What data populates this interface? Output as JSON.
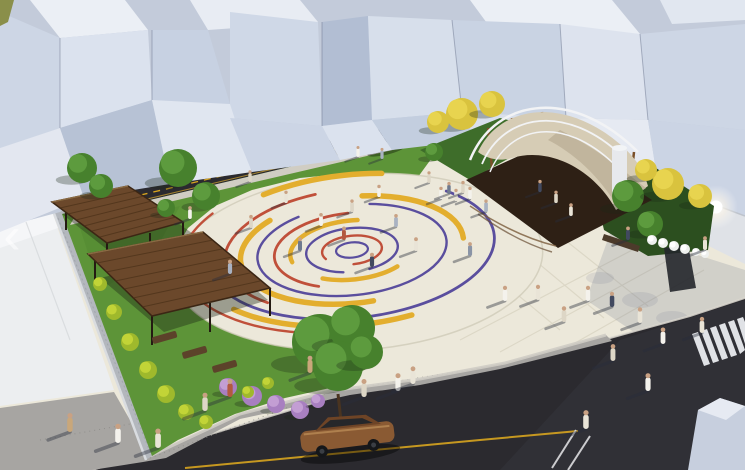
{
  "meta": {
    "title": "Aerial 3D rendering of a public plaza design",
    "description": "Urban square with concentric colored pavement circles, wooden pergolas, shade canopy stage, trees, streets and pedestrians"
  },
  "carousel": {
    "prev_glyph": "‹"
  },
  "palette": {
    "accent_red": "#c0503a",
    "accent_yellow": "#e3ae2e",
    "accent_purple": "#5a4e9e",
    "pavement_cream": "#ece8da",
    "grass_green": "#5d9438",
    "asphalt_dark": "#2b2a2f",
    "road_line_yellow": "#d7a41f",
    "wood_brown": "#6b482b",
    "canopy_tan": "#d6ccb5",
    "building_white": "#dfe5ef",
    "stone_wall_gray": "#b3b7bd",
    "car_bronze": "#8a5a33",
    "car_silver": "#c6cfdb",
    "lamp_glow": "#ffffff"
  },
  "scene": {
    "plaza": {
      "center_x": 352,
      "center_y": 250,
      "squash": 0.476,
      "rotate": -6,
      "arcs": [
        {
          "rx": 16,
          "color": "accent_purple",
          "w": 2.2,
          "dash": "100 0",
          "off": 0
        },
        {
          "rx": 30,
          "color": "accent_red",
          "w": 2.4,
          "dash": "80 20",
          "off": 55
        },
        {
          "rx": 46,
          "color": "accent_purple",
          "w": 2.4,
          "dash": "88 12",
          "off": 70
        },
        {
          "rx": 62,
          "color": "accent_yellow",
          "w": 4.5,
          "dash": "26 12 30 32",
          "off": 90
        },
        {
          "rx": 78,
          "color": "accent_red",
          "w": 2.8,
          "dash": "40 60",
          "off": 65
        },
        {
          "rx": 95,
          "color": "accent_purple",
          "w": 2.4,
          "dash": "84 16",
          "off": 20
        },
        {
          "rx": 112,
          "color": "accent_yellow",
          "w": 5.5,
          "dash": "38 18 22 22",
          "off": 78
        },
        {
          "rx": 128,
          "color": "accent_red",
          "w": 2.8,
          "dash": "30 70",
          "off": 60
        },
        {
          "rx": 143,
          "color": "accent_purple",
          "w": 2.8,
          "dash": "55 45",
          "off": 10
        },
        {
          "rx": 158,
          "color": "accent_yellow",
          "w": 5.5,
          "dash": "24 22 16 38",
          "off": 82
        },
        {
          "rx": 172,
          "color": "accent_red",
          "w": 2.4,
          "dash": "26 74",
          "off": 68
        }
      ]
    },
    "people_colors": [
      "#f4f2ec",
      "#ddd6c6",
      "#a9b2c2",
      "#6f7a8e",
      "#b3593f",
      "#41495f",
      "#e9e4d7",
      "#8a94a6",
      "#c9a77a"
    ],
    "people": [
      [
        190,
        219,
        0
      ],
      [
        230,
        274,
        2
      ],
      [
        251,
        228,
        1
      ],
      [
        286,
        203,
        6
      ],
      [
        300,
        251,
        3
      ],
      [
        321,
        226,
        0
      ],
      [
        344,
        240,
        4
      ],
      [
        352,
        212,
        1
      ],
      [
        372,
        267,
        5
      ],
      [
        379,
        197,
        0
      ],
      [
        396,
        227,
        2
      ],
      [
        416,
        251,
        6
      ],
      [
        429,
        183,
        1
      ],
      [
        441,
        199,
        0
      ],
      [
        449,
        194,
        3
      ],
      [
        456,
        201,
        6
      ],
      [
        463,
        193,
        1
      ],
      [
        470,
        199,
        0
      ],
      [
        486,
        212,
        2
      ],
      [
        470,
        256,
        7
      ],
      [
        505,
        301,
        0
      ],
      [
        538,
        300,
        6
      ],
      [
        564,
        322,
        1
      ],
      [
        588,
        301,
        0
      ],
      [
        612,
        307,
        5
      ],
      [
        640,
        323,
        6
      ],
      [
        663,
        344,
        0
      ],
      [
        702,
        333,
        6
      ],
      [
        613,
        361,
        1
      ],
      [
        648,
        391,
        0
      ],
      [
        586,
        429,
        6
      ],
      [
        398,
        391,
        0
      ],
      [
        413,
        384,
        6
      ],
      [
        364,
        397,
        1
      ],
      [
        310,
        373,
        8
      ],
      [
        230,
        397,
        4
      ],
      [
        158,
        448,
        6
      ],
      [
        118,
        443,
        0
      ],
      [
        70,
        432,
        8
      ],
      [
        205,
        411,
        1
      ],
      [
        540,
        192,
        5
      ],
      [
        556,
        203,
        1
      ],
      [
        571,
        216,
        6
      ],
      [
        628,
        240,
        5
      ],
      [
        705,
        250,
        6
      ],
      [
        250,
        182,
        1
      ],
      [
        358,
        157,
        0
      ],
      [
        382,
        159,
        2
      ]
    ],
    "vegetation": [
      [
        82,
        168,
        15,
        "g"
      ],
      [
        101,
        186,
        12,
        "g"
      ],
      [
        178,
        168,
        19,
        "g"
      ],
      [
        206,
        196,
        14,
        "g"
      ],
      [
        166,
        208,
        9,
        "g"
      ],
      [
        434,
        152,
        9,
        "g"
      ],
      [
        650,
        224,
        13,
        "g"
      ],
      [
        628,
        196,
        16,
        "g"
      ],
      [
        320,
        342,
        28,
        "g"
      ],
      [
        352,
        328,
        23,
        "g"
      ],
      [
        338,
        366,
        25,
        "g"
      ],
      [
        366,
        352,
        17,
        "g"
      ],
      [
        462,
        114,
        16,
        "y"
      ],
      [
        492,
        104,
        13,
        "y"
      ],
      [
        438,
        122,
        11,
        "y"
      ],
      [
        668,
        184,
        16,
        "y"
      ],
      [
        700,
        196,
        12,
        "y"
      ],
      [
        646,
        170,
        11,
        "y"
      ],
      [
        228,
        387,
        9,
        "l"
      ],
      [
        252,
        396,
        10,
        "l"
      ],
      [
        276,
        404,
        9,
        "l"
      ],
      [
        300,
        410,
        9,
        "l"
      ],
      [
        318,
        401,
        7,
        "l"
      ],
      [
        100,
        284,
        7,
        "s"
      ],
      [
        114,
        312,
        8,
        "s"
      ],
      [
        130,
        342,
        9,
        "s"
      ],
      [
        148,
        370,
        9,
        "s"
      ],
      [
        166,
        394,
        9,
        "s"
      ],
      [
        186,
        412,
        8,
        "s"
      ],
      [
        206,
        422,
        7,
        "s"
      ],
      [
        248,
        392,
        6,
        "s"
      ],
      [
        268,
        383,
        6,
        "s"
      ],
      [
        652,
        240,
        5,
        "w"
      ],
      [
        663,
        243,
        5,
        "w"
      ],
      [
        674,
        246,
        5,
        "w"
      ],
      [
        685,
        249,
        5,
        "w"
      ],
      [
        696,
        252,
        4,
        "w"
      ],
      [
        705,
        254,
        4,
        "w"
      ]
    ]
  }
}
